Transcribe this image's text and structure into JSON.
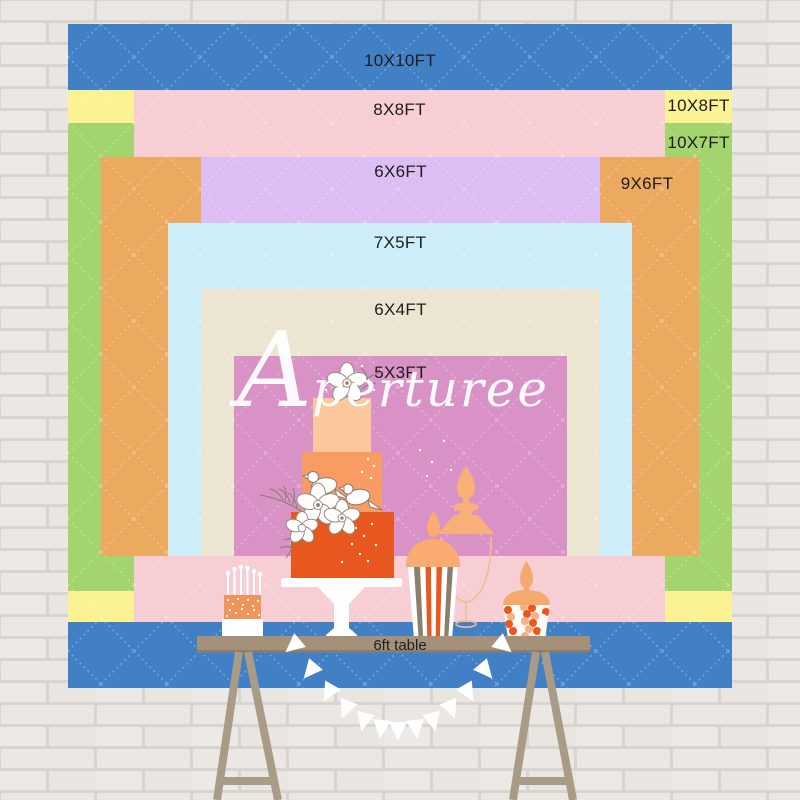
{
  "backdrop": {
    "watermark": "Aperturee",
    "label_color": "#1d1d1d",
    "pattern": "white dashed diamond quilting",
    "sizes": [
      {
        "label": "10X10FT",
        "color": "#4280c6"
      },
      {
        "label": "8X8FT",
        "color": "#f7ced3"
      },
      {
        "label": "10X8FT",
        "color": "#fbf294"
      },
      {
        "label": "10X7FT",
        "color": "#a3d46e"
      },
      {
        "label": "6X6FT",
        "color": "#dcbef4"
      },
      {
        "label": "9X6FT",
        "color": "#ecaa60"
      },
      {
        "label": "7X5FT",
        "color": "#cdeef9"
      },
      {
        "label": "6X4FT",
        "color": "#ebe5d2"
      },
      {
        "label": "5X3FT",
        "color": "#d992c6"
      }
    ]
  },
  "table": {
    "label": "6ft table",
    "top_color": "#a5917a",
    "leg_color": "#a89c86"
  },
  "scene": {
    "wall": "white painted brick",
    "decor": [
      "three-tier-cake",
      "candle-cake",
      "glass-jar",
      "popcorn-cup",
      "candy-bowl",
      "pennant-bunting"
    ],
    "cake_colors": {
      "top_tier": "#fbc79c",
      "middle_tier": "#f89c63",
      "bottom_tier": "#e8571d",
      "accent_orange": "#e8581f",
      "peach": "#f9ab72"
    }
  }
}
